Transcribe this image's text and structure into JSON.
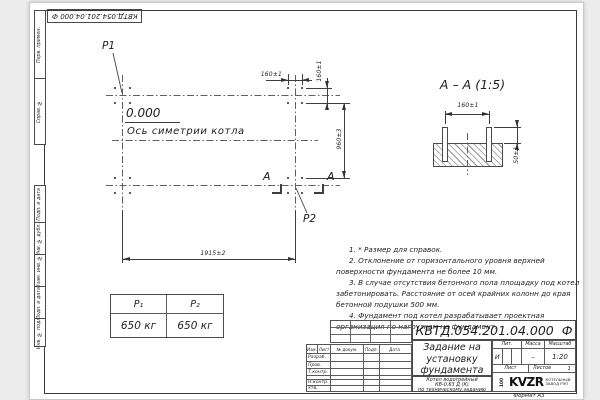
{
  "page": {
    "stamp_top": "КВТД.054.201.04.000 Ф",
    "format_label": "Формат А3"
  },
  "margin_labels": {
    "g1": [
      "Перв. примен.",
      "Справ. №"
    ],
    "g2": [
      "Подп. и дата",
      "Инв. № дубл.",
      "Взам. инв. №",
      "Подп. и дата",
      "Инв. № подл."
    ]
  },
  "plan": {
    "p1": "P1",
    "p2": "P2",
    "elevation": "0.000",
    "axis_label": "Ось симетрии котла",
    "dim_160_top": "160±1",
    "dim_160_right": "160±1",
    "dim_960": "960±3",
    "dim_1915": "1915±2",
    "section_letter": "А"
  },
  "section": {
    "title": "А – А (1:5)",
    "dim_160": "160±1",
    "dim_50": "50±1"
  },
  "notes": [
    "1. * Размер для справок.",
    "2. Отклонение от горизонтального уровня верхней поверхности фундамента не более 10 мм.",
    "3. В случае отсутствия бетонного пола площадку под котел забетонировать. Расстояние от осей крайних колонн до края бетонной подушки 500 мм.",
    "4. Фундамент под котел разрабатывает проектная организация по нагрузкам на фундамент."
  ],
  "load_table": {
    "headers": [
      "P₁",
      "P₂"
    ],
    "values": [
      "650 кг",
      "650 кг"
    ]
  },
  "title_block": {
    "designation": "КВТД.054.201.04.000  Ф",
    "doc_title_lines": [
      "Задание на",
      "установку",
      "фундамента"
    ],
    "product_lines": [
      "Котел водогрейный",
      "КВ-0,63 Д (К)",
      "по техническому заданию"
    ],
    "header_cols": [
      "Изм.",
      "Лист",
      "№ докум.",
      "Подп.",
      "Дата"
    ],
    "row_labels": [
      "Разраб.",
      "Пров.",
      "Т.контр.",
      "",
      "Н.контр.",
      "Утв."
    ],
    "lit_label": "Лит.",
    "mass_label": "Масса",
    "scale_label": "Масштаб",
    "lit_value": "И",
    "mass_value": "–",
    "scale_value": "1:20",
    "sheet_label": "Лист",
    "sheets_label": "Листов",
    "sheets_value": "1",
    "logo": "KVZR",
    "logo_mark": "100",
    "logo_sub1": "КОТЕЛЬНЫЙ",
    "logo_sub2": "ЗАВОД РЭП"
  }
}
